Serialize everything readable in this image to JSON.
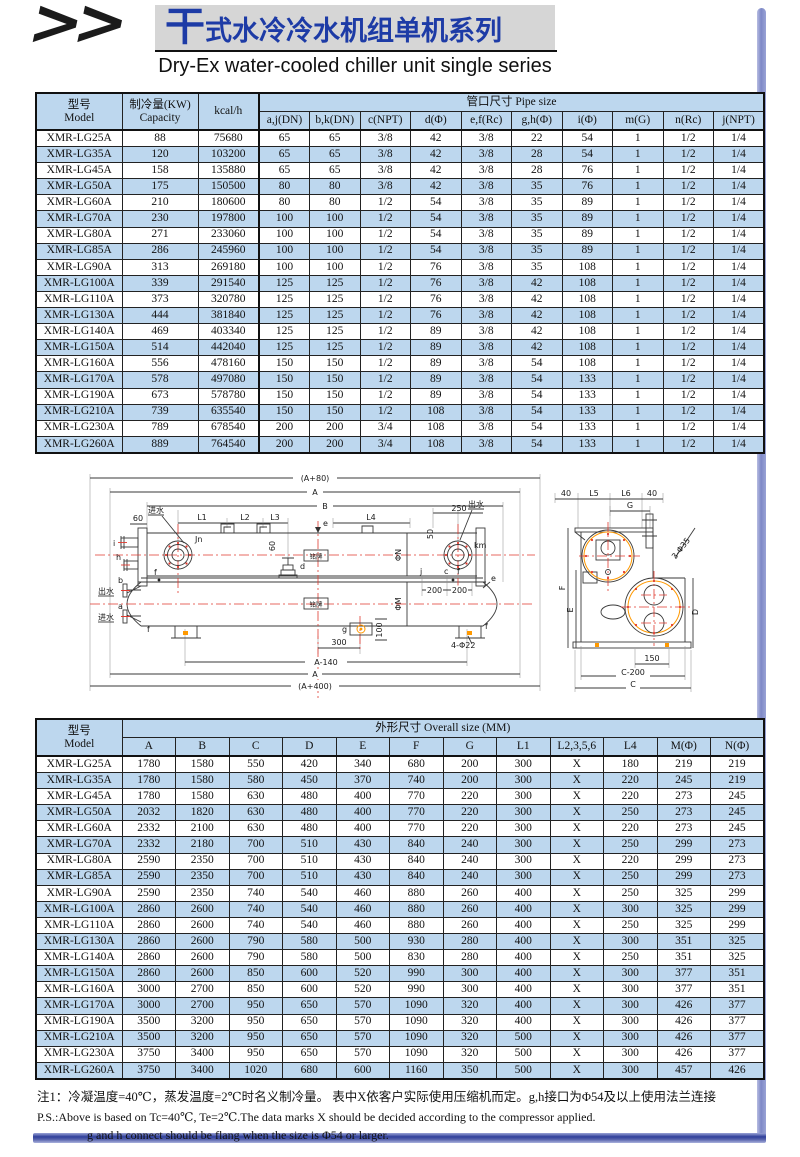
{
  "header": {
    "chevrons": ">>",
    "title_accent": "干",
    "title_rest": "式水冷冷水机组单机系列",
    "subtitle": "Dry-Ex water-cooled chiller unit single series"
  },
  "colors": {
    "accent_blue": "#1d3ba6",
    "table_stripe": "#bdd7ee",
    "bar_navy": "#2f3f9a",
    "bar_periwinkle": "#9aa3d6",
    "diagram_red": "#e03a2f",
    "diagram_orange": "#ff9900"
  },
  "pipe_table": {
    "model_header": {
      "zh": "型号",
      "en": "Model"
    },
    "capacity_header": {
      "zh": "制冷量(KW)",
      "en": "Capacity"
    },
    "kcal_header": "kcal/h",
    "group_header": "管口尺寸 Pipe size",
    "columns": [
      "a,j(DN)",
      "b,k(DN)",
      "c(NPT)",
      "d(Φ)",
      "e,f(Rc)",
      "g,h(Φ)",
      "i(Φ)",
      "m(G)",
      "n(Rc)",
      "j(NPT)"
    ],
    "rows": [
      [
        "XMR-LG25A",
        "88",
        "75680",
        "65",
        "65",
        "3/8",
        "42",
        "3/8",
        "22",
        "54",
        "1",
        "1/2",
        "1/4"
      ],
      [
        "XMR-LG35A",
        "120",
        "103200",
        "65",
        "65",
        "3/8",
        "42",
        "3/8",
        "28",
        "54",
        "1",
        "1/2",
        "1/4"
      ],
      [
        "XMR-LG45A",
        "158",
        "135880",
        "65",
        "65",
        "3/8",
        "42",
        "3/8",
        "28",
        "76",
        "1",
        "1/2",
        "1/4"
      ],
      [
        "XMR-LG50A",
        "175",
        "150500",
        "80",
        "80",
        "3/8",
        "42",
        "3/8",
        "35",
        "76",
        "1",
        "1/2",
        "1/4"
      ],
      [
        "XMR-LG60A",
        "210",
        "180600",
        "80",
        "80",
        "1/2",
        "54",
        "3/8",
        "35",
        "89",
        "1",
        "1/2",
        "1/4"
      ],
      [
        "XMR-LG70A",
        "230",
        "197800",
        "100",
        "100",
        "1/2",
        "54",
        "3/8",
        "35",
        "89",
        "1",
        "1/2",
        "1/4"
      ],
      [
        "XMR-LG80A",
        "271",
        "233060",
        "100",
        "100",
        "1/2",
        "54",
        "3/8",
        "35",
        "89",
        "1",
        "1/2",
        "1/4"
      ],
      [
        "XMR-LG85A",
        "286",
        "245960",
        "100",
        "100",
        "1/2",
        "54",
        "3/8",
        "35",
        "89",
        "1",
        "1/2",
        "1/4"
      ],
      [
        "XMR-LG90A",
        "313",
        "269180",
        "100",
        "100",
        "1/2",
        "76",
        "3/8",
        "35",
        "108",
        "1",
        "1/2",
        "1/4"
      ],
      [
        "XMR-LG100A",
        "339",
        "291540",
        "125",
        "125",
        "1/2",
        "76",
        "3/8",
        "42",
        "108",
        "1",
        "1/2",
        "1/4"
      ],
      [
        "XMR-LG110A",
        "373",
        "320780",
        "125",
        "125",
        "1/2",
        "76",
        "3/8",
        "42",
        "108",
        "1",
        "1/2",
        "1/4"
      ],
      [
        "XMR-LG130A",
        "444",
        "381840",
        "125",
        "125",
        "1/2",
        "76",
        "3/8",
        "42",
        "108",
        "1",
        "1/2",
        "1/4"
      ],
      [
        "XMR-LG140A",
        "469",
        "403340",
        "125",
        "125",
        "1/2",
        "89",
        "3/8",
        "42",
        "108",
        "1",
        "1/2",
        "1/4"
      ],
      [
        "XMR-LG150A",
        "514",
        "442040",
        "125",
        "125",
        "1/2",
        "89",
        "3/8",
        "42",
        "108",
        "1",
        "1/2",
        "1/4"
      ],
      [
        "XMR-LG160A",
        "556",
        "478160",
        "150",
        "150",
        "1/2",
        "89",
        "3/8",
        "54",
        "108",
        "1",
        "1/2",
        "1/4"
      ],
      [
        "XMR-LG170A",
        "578",
        "497080",
        "150",
        "150",
        "1/2",
        "89",
        "3/8",
        "54",
        "133",
        "1",
        "1/2",
        "1/4"
      ],
      [
        "XMR-LG190A",
        "673",
        "578780",
        "150",
        "150",
        "1/2",
        "89",
        "3/8",
        "54",
        "133",
        "1",
        "1/2",
        "1/4"
      ],
      [
        "XMR-LG210A",
        "739",
        "635540",
        "150",
        "150",
        "1/2",
        "108",
        "3/8",
        "54",
        "133",
        "1",
        "1/2",
        "1/4"
      ],
      [
        "XMR-LG230A",
        "789",
        "678540",
        "200",
        "200",
        "3/4",
        "108",
        "3/8",
        "54",
        "133",
        "1",
        "1/2",
        "1/4"
      ],
      [
        "XMR-LG260A",
        "889",
        "764540",
        "200",
        "200",
        "3/4",
        "108",
        "3/8",
        "54",
        "133",
        "1",
        "1/2",
        "1/4"
      ]
    ]
  },
  "size_table": {
    "model_header": {
      "zh": "型号",
      "en": "Model"
    },
    "group_header": "外形尺寸 Overall size (MM)",
    "columns": [
      "A",
      "B",
      "C",
      "D",
      "E",
      "F",
      "G",
      "L1",
      "L2,3,5,6",
      "L4",
      "M(Φ)",
      "N(Φ)"
    ],
    "rows": [
      [
        "XMR-LG25A",
        "1780",
        "1580",
        "550",
        "420",
        "340",
        "680",
        "200",
        "300",
        "X",
        "180",
        "219",
        "219"
      ],
      [
        "XMR-LG35A",
        "1780",
        "1580",
        "580",
        "450",
        "370",
        "740",
        "200",
        "300",
        "X",
        "220",
        "245",
        "219"
      ],
      [
        "XMR-LG45A",
        "1780",
        "1580",
        "630",
        "480",
        "400",
        "770",
        "220",
        "300",
        "X",
        "220",
        "273",
        "245"
      ],
      [
        "XMR-LG50A",
        "2032",
        "1820",
        "630",
        "480",
        "400",
        "770",
        "220",
        "300",
        "X",
        "250",
        "273",
        "245"
      ],
      [
        "XMR-LG60A",
        "2332",
        "2100",
        "630",
        "480",
        "400",
        "770",
        "220",
        "300",
        "X",
        "220",
        "273",
        "245"
      ],
      [
        "XMR-LG70A",
        "2332",
        "2180",
        "700",
        "510",
        "430",
        "840",
        "240",
        "300",
        "X",
        "250",
        "299",
        "273"
      ],
      [
        "XMR-LG80A",
        "2590",
        "2350",
        "700",
        "510",
        "430",
        "840",
        "240",
        "300",
        "X",
        "220",
        "299",
        "273"
      ],
      [
        "XMR-LG85A",
        "2590",
        "2350",
        "700",
        "510",
        "430",
        "840",
        "240",
        "300",
        "X",
        "250",
        "299",
        "273"
      ],
      [
        "XMR-LG90A",
        "2590",
        "2350",
        "740",
        "540",
        "460",
        "880",
        "260",
        "400",
        "X",
        "250",
        "325",
        "299"
      ],
      [
        "XMR-LG100A",
        "2860",
        "2600",
        "740",
        "540",
        "460",
        "880",
        "260",
        "400",
        "X",
        "300",
        "325",
        "299"
      ],
      [
        "XMR-LG110A",
        "2860",
        "2600",
        "740",
        "540",
        "460",
        "880",
        "260",
        "400",
        "X",
        "250",
        "325",
        "299"
      ],
      [
        "XMR-LG130A",
        "2860",
        "2600",
        "790",
        "580",
        "500",
        "930",
        "280",
        "400",
        "X",
        "300",
        "351",
        "325"
      ],
      [
        "XMR-LG140A",
        "2860",
        "2600",
        "790",
        "580",
        "500",
        "830",
        "280",
        "400",
        "X",
        "250",
        "351",
        "325"
      ],
      [
        "XMR-LG150A",
        "2860",
        "2600",
        "850",
        "600",
        "520",
        "990",
        "300",
        "400",
        "X",
        "300",
        "377",
        "351"
      ],
      [
        "XMR-LG160A",
        "3000",
        "2700",
        "850",
        "600",
        "520",
        "990",
        "300",
        "400",
        "X",
        "300",
        "377",
        "351"
      ],
      [
        "XMR-LG170A",
        "3000",
        "2700",
        "950",
        "650",
        "570",
        "1090",
        "320",
        "400",
        "X",
        "300",
        "426",
        "377"
      ],
      [
        "XMR-LG190A",
        "3500",
        "3200",
        "950",
        "650",
        "570",
        "1090",
        "320",
        "400",
        "X",
        "300",
        "426",
        "377"
      ],
      [
        "XMR-LG210A",
        "3500",
        "3200",
        "950",
        "650",
        "570",
        "1090",
        "320",
        "500",
        "X",
        "300",
        "426",
        "377"
      ],
      [
        "XMR-LG230A",
        "3750",
        "3400",
        "950",
        "650",
        "570",
        "1090",
        "320",
        "500",
        "X",
        "300",
        "426",
        "377"
      ],
      [
        "XMR-LG260A",
        "3750",
        "3400",
        "1020",
        "680",
        "600",
        "1160",
        "350",
        "500",
        "X",
        "300",
        "457",
        "426"
      ]
    ]
  },
  "notes": {
    "line1": "注1：冷凝温度=40℃，蒸发温度=2℃时名义制冷量。 表中X依客户实际使用压缩机而定。g,h接口为Φ54及以上使用法兰连接",
    "line2": "P.S.:Above is based on Tc=40℃, Te=2℃.The data marks X should be decided according to the compressor applied.",
    "line3": "g and h connect should be flang when the size is Φ54 or larger."
  },
  "diagram": {
    "side": {
      "a80": "(A+80)",
      "a": "A",
      "b": "B",
      "l1": "L1",
      "l2": "L2",
      "l3": "L3",
      "l4": "L4",
      "d250": "250",
      "d60": "60",
      "d50": "50",
      "d200": "200",
      "d300": "300",
      "d100": "100",
      "a140": "A-140",
      "a400": "(A+400)",
      "bolts": "4-Φ22",
      "water_in": "进水",
      "water_out": "出水",
      "jn": "Jn",
      "km": "km",
      "phi_n": "ΦN",
      "phi_m": "ΦM",
      "nameplate": "铭牌",
      "pts": {
        "a": "a",
        "b": "b",
        "c": "c",
        "d": "d",
        "e": "e",
        "f": "f",
        "g": "g",
        "h": "h",
        "i": "i",
        "j": "j"
      }
    },
    "end": {
      "d40": "40",
      "l5": "L5",
      "l6": "L6",
      "g": "G",
      "f": "F",
      "e": "E",
      "d": "D",
      "c": "C",
      "c200": "C-200",
      "d150": "150",
      "callout": "3-Φ35"
    }
  }
}
